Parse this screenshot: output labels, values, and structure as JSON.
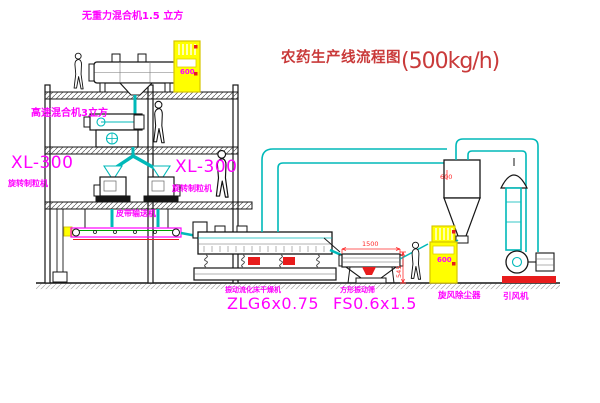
{
  "title": {
    "name_zh": "农药生产线流程图",
    "capacity": "(500kg/h)"
  },
  "labels": {
    "gravity_mixer": "无重力混合机1.5 立方",
    "high_speed_mixer": "高速混合机3立方",
    "granulator_left_model": "XL-300",
    "granulator_left_name": "旋转制粒机",
    "granulator_mid_model": "XL-300",
    "granulator_mid_name": "旋转制粒机",
    "belt_conveyor": "皮带输送机",
    "dryer_name": "振动流化床干燥机",
    "dryer_model": "ZLG6x0.75",
    "sieve_name": "方形振动筛",
    "sieve_model": "FS0.6x1.5",
    "cyclone": "旋风除尘器",
    "fan": "引风机"
  },
  "dimensions": {
    "sieve_width": "1500",
    "sieve_height": "545",
    "duct_diameter": "600"
  },
  "elevator_marking": "600",
  "colors": {
    "label_magenta": "#ff00ff",
    "title_red": "#c93a3a",
    "dimension_red": "#ff2a2a",
    "line_cyan": "#00b9b9",
    "structure_dark": "#161616",
    "elevator_yellow": "#ffff00",
    "belt_green": "#00a000",
    "background": "#ffffff"
  }
}
